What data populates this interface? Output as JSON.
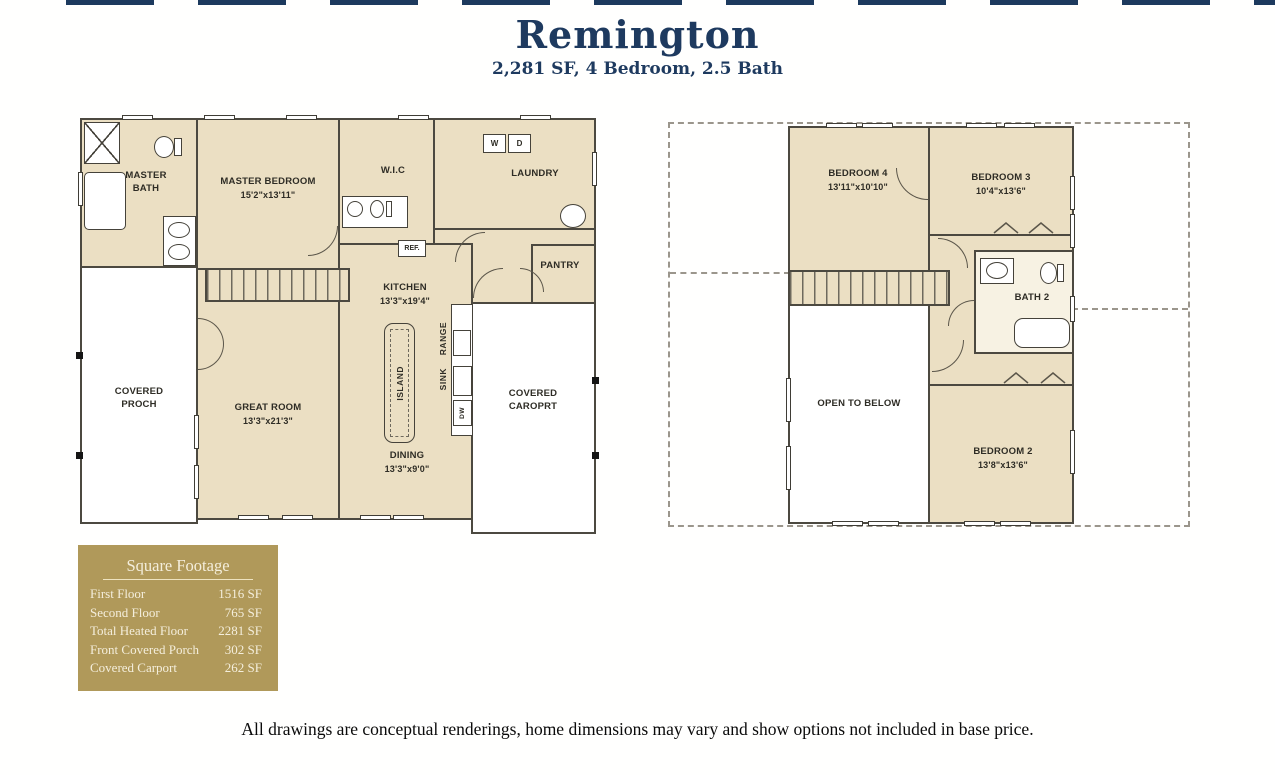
{
  "header": {
    "title": "Remington",
    "subtitle": "2,281 SF, 4 Bedroom, 2.5 Bath"
  },
  "colors": {
    "navy": "#1e3a5f",
    "room_fill": "#ebdfc3",
    "wall": "#4c4940",
    "gold_box": "#b0995a",
    "gold_text": "#f4eedc"
  },
  "first_floor": {
    "rooms": {
      "master_bath": {
        "name": "MASTER BATH",
        "dims": ""
      },
      "master_bedroom": {
        "name": "MASTER BEDROOM",
        "dims": "15'2\"x13'11\""
      },
      "wic": {
        "name": "W.I.C",
        "dims": ""
      },
      "laundry": {
        "name": "LAUNDRY",
        "dims": ""
      },
      "pantry": {
        "name": "PANTRY",
        "dims": ""
      },
      "kitchen": {
        "name": "KITCHEN",
        "dims": "13'3\"x19'4\""
      },
      "dining": {
        "name": "DINING",
        "dims": "13'3\"x9'0\""
      },
      "great_room": {
        "name": "GREAT ROOM",
        "dims": "13'3\"x21'3\""
      },
      "covered_porch": {
        "name": "COVERED PROCH",
        "dims": ""
      },
      "covered_carport": {
        "name": "COVERED CAROPRT",
        "dims": ""
      }
    },
    "labels": {
      "washer": "W",
      "dryer": "D",
      "ref": "REF.",
      "island": "ISLAND",
      "range": "RANGE",
      "sink": "SINK",
      "dw": "DW"
    }
  },
  "second_floor": {
    "rooms": {
      "bedroom4": {
        "name": "BEDROOM 4",
        "dims": "13'11\"x10'10\""
      },
      "bedroom3": {
        "name": "BEDROOM 3",
        "dims": "10'4\"x13'6\""
      },
      "bath2": {
        "name": "BATH 2",
        "dims": ""
      },
      "bedroom2": {
        "name": "BEDROOM 2",
        "dims": "13'8\"x13'6\""
      },
      "open_to_below": {
        "name": "OPEN TO BELOW",
        "dims": ""
      }
    }
  },
  "square_footage": {
    "title": "Square Footage",
    "rows": [
      {
        "label": "First Floor",
        "value": "1516 SF"
      },
      {
        "label": "Second Floor",
        "value": "765 SF"
      },
      {
        "label": "Total Heated Floor",
        "value": "2281 SF"
      },
      {
        "label": "Front Covered Porch",
        "value": "302 SF"
      },
      {
        "label": "Covered Carport",
        "value": "262 SF"
      }
    ]
  },
  "footer": {
    "disclaimer": "All drawings are conceptual renderings, home dimensions may vary and show options not included in base price."
  }
}
